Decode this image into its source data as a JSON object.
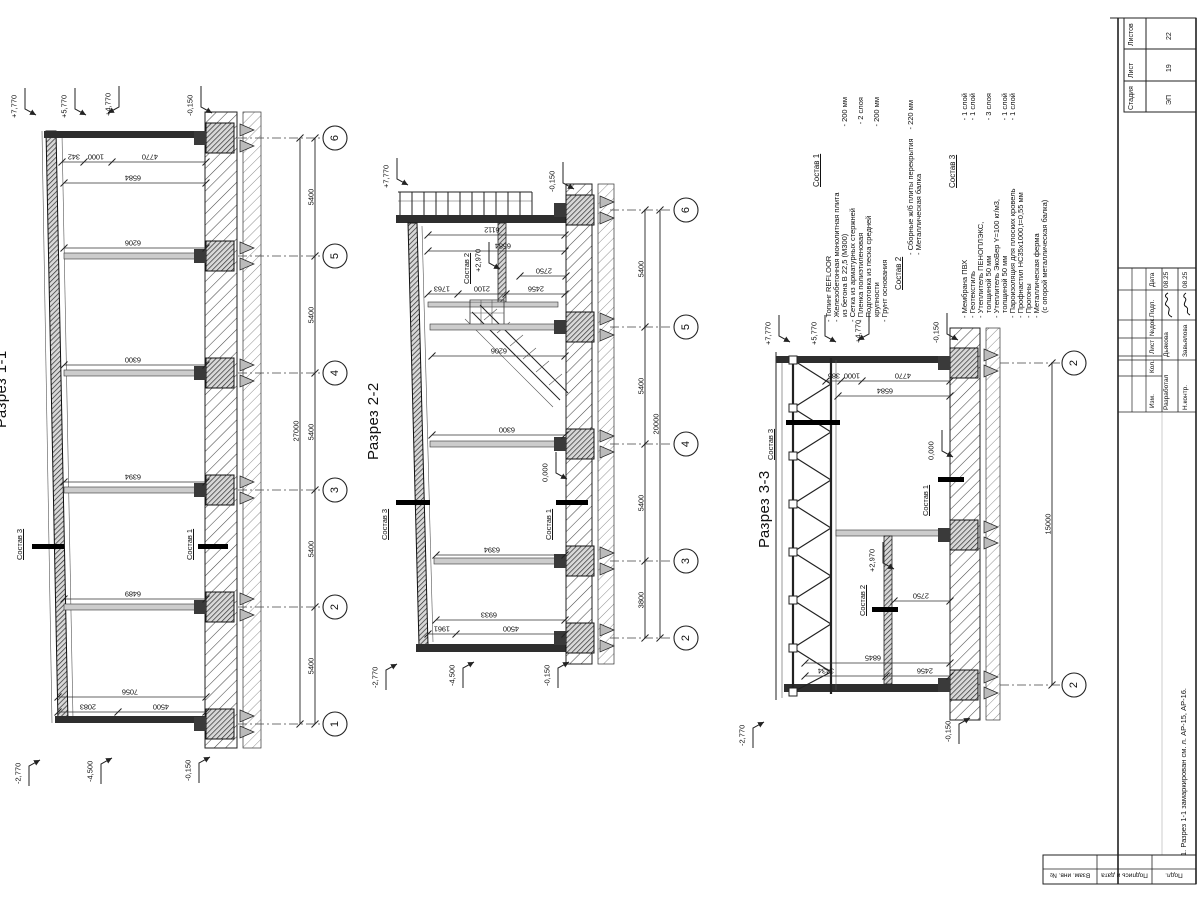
{
  "s1": {
    "title": "Разрез 1-1",
    "elev_top": [
      "+7,770",
      "+5,770",
      "+4,770",
      "-0,150"
    ],
    "elev_bot": [
      "-2,770",
      "-4,500",
      "-0,150"
    ],
    "dims_top": [
      "342",
      "1000",
      "4770"
    ],
    "dims_bay": [
      "6584",
      "6206",
      "6300",
      "6394",
      "6489"
    ],
    "dims_bot": [
      "7056",
      "2083",
      "4500"
    ],
    "spans": [
      "5400",
      "5400",
      "5400",
      "5400",
      "5400"
    ],
    "total": "27000",
    "bubbles": [
      "6",
      "5",
      "4",
      "3",
      "2",
      "1"
    ],
    "lbl_c3": "Состав 3",
    "lbl_c1": "Состав 1"
  },
  "s2": {
    "title": "Разрез 2-2",
    "elev_top": [
      "+7,770",
      "-0,150"
    ],
    "elev_bot": [
      "-2,770",
      "-4,500",
      "-0,150"
    ],
    "elev_zero": "0,000",
    "elev_mezz": "+2,970",
    "dims_top": [
      "6112",
      "6584"
    ],
    "dims_mezz": [
      "1763",
      "2100",
      "2456",
      "2750"
    ],
    "dims_bay": [
      "6206",
      "6300",
      "6394",
      "6933"
    ],
    "dims_bot": [
      "1961",
      "4500"
    ],
    "spans": [
      "5400",
      "5400",
      "5400",
      "3800"
    ],
    "total": "20000",
    "bubbles": [
      "6",
      "5",
      "4",
      "3",
      "2"
    ],
    "lbl_c2": "Состав 2",
    "lbl_c3": "Состав 3",
    "lbl_c1": "Состав 1"
  },
  "s3": {
    "title": "Разрез 3-3",
    "elev_top": [
      "+7,770",
      "+5,770",
      "+4,770",
      "-0,150"
    ],
    "elev_bot": [
      "-2,770",
      "-0,150"
    ],
    "elev_zero": "0,000",
    "elev_mezz": "+2,970",
    "dims_top": [
      "385",
      "1000",
      "4770",
      "6584"
    ],
    "dims_bot": [
      "6845",
      "3434",
      "2456",
      "2750"
    ],
    "total": "15000",
    "bubbles": [
      "2",
      "2"
    ],
    "lbl_c3": "Состав 3",
    "lbl_c1": "Состав 1",
    "lbl_c2": "Состав 2"
  },
  "comp1": {
    "title": "Состав 1",
    "items": [
      {
        "t": "- Топинг REFLOOR",
        "v": ""
      },
      {
        "t": "- Железобетонная монолитная плита",
        "v": ""
      },
      {
        "t": "из бетона В 22,5 (М300)",
        "v": "- 200 мм"
      },
      {
        "t": "- Сетка из арматурных стержней",
        "v": ""
      },
      {
        "t": "- Пленка полиэтиленовая",
        "v": "- 2 слоя"
      },
      {
        "t": "- Подготовка из песка средней",
        "v": ""
      },
      {
        "t": "крупности",
        "v": "- 200 мм"
      },
      {
        "t": "- Грунт основания",
        "v": ""
      }
    ]
  },
  "comp2": {
    "title": "Состав 2",
    "items": [
      {
        "t": "- Сборные ж/б плиты перекрытия",
        "v": "- 220 мм"
      },
      {
        "t": "- Металлическая балка",
        "v": ""
      }
    ]
  },
  "comp3": {
    "title": "Состав 3",
    "items": [
      {
        "t": "- Мембрана ПВХ",
        "v": "- 1 слой"
      },
      {
        "t": "- Геотекстиль",
        "v": "- 1 слой"
      },
      {
        "t": "- Утеплитель ПЕНОПЛЭКС,",
        "v": ""
      },
      {
        "t": "толщиной 50 мм",
        "v": "- 3 слоя"
      },
      {
        "t": "- Утеплитель ЭкоВер Y=100 кг/м3,",
        "v": ""
      },
      {
        "t": "толщиной 50 мм",
        "v": "- 1 слой"
      },
      {
        "t": "- Пароизоляция для плоских кровель",
        "v": "- 1 слой"
      },
      {
        "t": "- Профнастил НС35х1000,t=0,55 мм",
        "v": ""
      },
      {
        "t": "- Прогоны",
        "v": ""
      },
      {
        "t": "- Металлическая ферма",
        "v": ""
      },
      {
        "t": "(с опорой металлическая балка)",
        "v": ""
      }
    ]
  },
  "tb": {
    "stage": [
      {
        "label": "Стадия",
        "value": "ЭП"
      },
      {
        "label": "Лист",
        "value": "19"
      },
      {
        "label": "Листов",
        "value": "22"
      }
    ],
    "rev_cols": [
      "Дата",
      "Подп.",
      "№док.",
      "Лист",
      "Кол.",
      "Изм."
    ],
    "sig1": {
      "role": "Разработал",
      "name": "Дьякова",
      "date": "08.25"
    },
    "sig2": {
      "role": "Н.контр.",
      "name": "Завьялова",
      "date": "08.25"
    },
    "note": "1. Разрез 1-1 замаркирован см. л. АР-15, АР-16.",
    "frame": [
      "Взам. инв. №",
      "Подпись и дата",
      "Подл."
    ]
  }
}
